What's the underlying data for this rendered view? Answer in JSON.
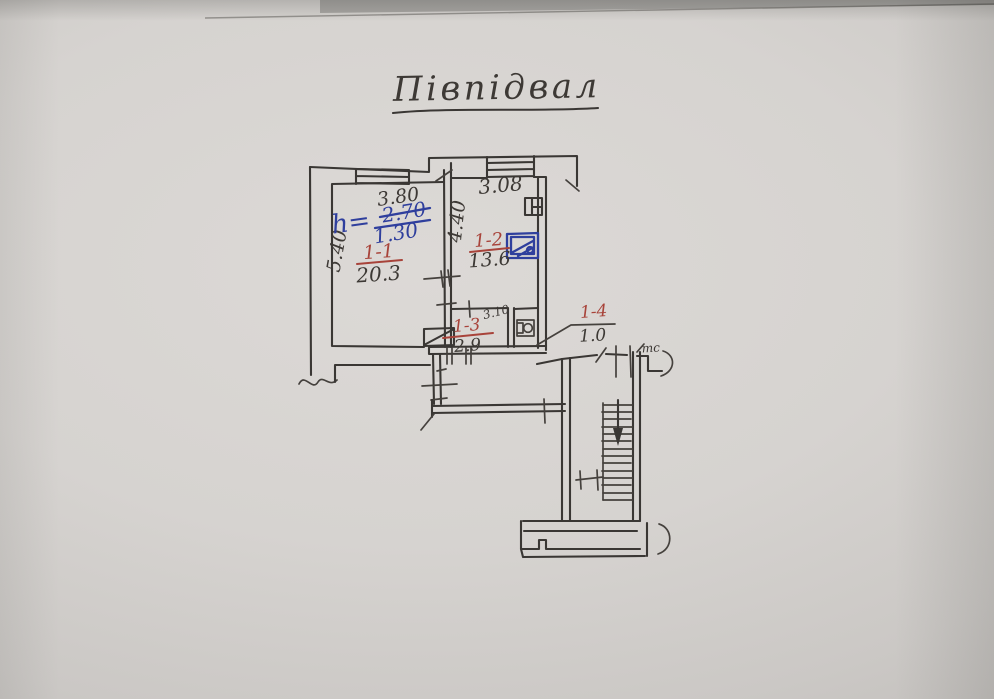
{
  "photo": {
    "paper_color": "#d7d4d1",
    "description": "hand-drawn floor plan sketch on paper"
  },
  "title": {
    "text": "Півпідвал"
  },
  "plan": {
    "colors": {
      "pencil": "#3a3734",
      "red_ink": "#a8433a",
      "blue_ink": "#2f3f9d"
    },
    "height_note": {
      "prefix": "h=",
      "old_value": "2.70",
      "old_value_struck": true,
      "new_value": "1.30"
    },
    "dimensions": {
      "room1_width": "3.80",
      "room1_depth": "5.40",
      "room2_width": "3.08",
      "room2_depth": "4.40",
      "room3_width": "3.10"
    },
    "rooms": [
      {
        "id": "1-1",
        "area": "20.3"
      },
      {
        "id": "1-2",
        "area": "13.6"
      },
      {
        "id": "1-3",
        "area": "2.9"
      },
      {
        "id": "1-4",
        "area": "1.0"
      }
    ],
    "wall_mark": "тс",
    "fixtures": [
      "window",
      "window",
      "flue",
      "stove",
      "toilet",
      "staircase-down"
    ]
  }
}
